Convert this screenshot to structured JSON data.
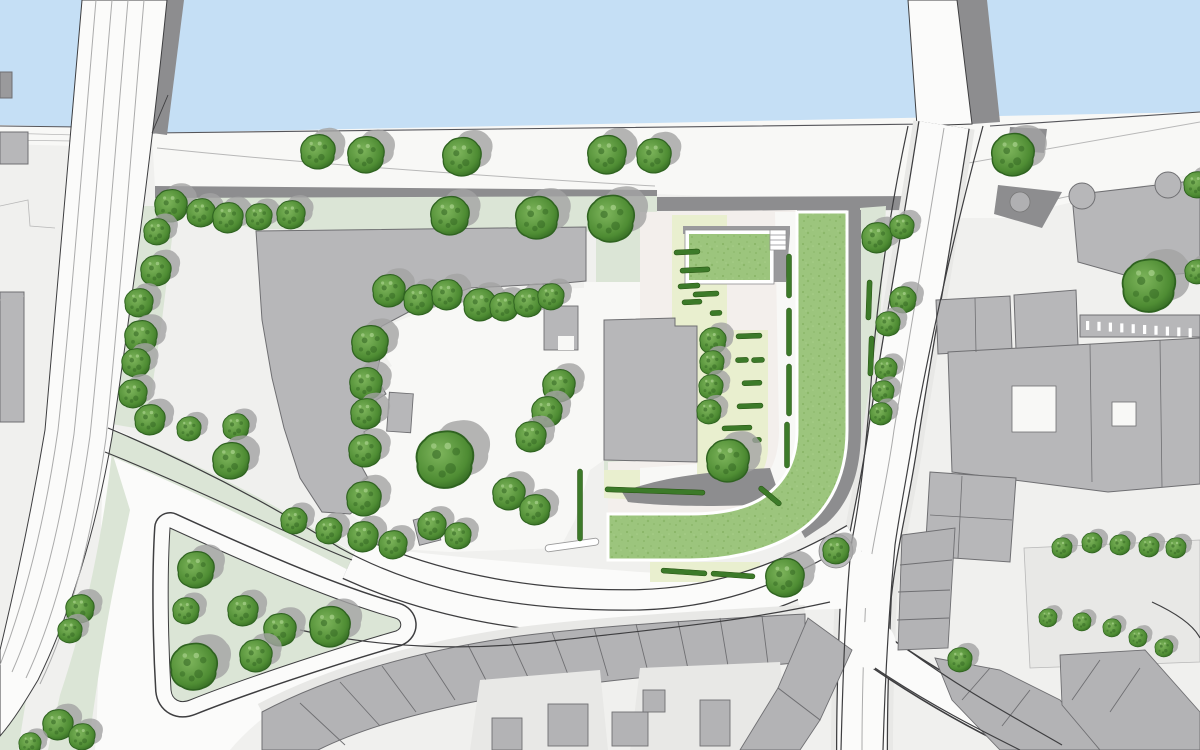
{
  "meta": {
    "title": "Riverside landscape masterplan site drawing",
    "type": "architectural-site-plan",
    "orientation": "plan view"
  },
  "palette": {
    "water": "#c5dff5",
    "land": "#f0f0ee",
    "road": "#fbfbfa",
    "sidewalk": "#e8e8e6",
    "plaza": "#f8f8f6",
    "dark_path": "#8d8d8f",
    "building": "#b7b7b9",
    "building_line": "#6f6f72",
    "terrace": "#b3b3b5",
    "sage": "#dbe5d6",
    "cream": "#e9efcf",
    "pink": "#f3efec",
    "lawn": "#9cc57d",
    "lawn_dark": "#85b263",
    "tree_mid": "#4e8c33",
    "tree_light": "#7eb55c",
    "tree_dark": "#2f6320",
    "tree_shadow": "#a3a3a3",
    "hedge": "#3c7a29",
    "hedge_dark": "#24500f",
    "line": "#3e3e40",
    "faint": "#b8b8b8",
    "lane": "#ababab"
  },
  "features": {
    "water_label": "river",
    "bridge_west": "road bridge with lane markings",
    "bridge_east": "road bridge",
    "promenade": "riverside promenade with tree row",
    "quay_path": "dark riverside walkway",
    "plaza": "central courtyard plaza",
    "lawn_building": "green-roof L-shaped building",
    "lawn_pavilion": "green-roof pavilion with stair",
    "park": "triangular pocket park",
    "terraces": "perimeter terrace housing",
    "court_grid": "courtyard with small tree grid"
  },
  "trees": {
    "promenade_row": [
      [
        318,
        152,
        17
      ],
      [
        366,
        155,
        18
      ],
      [
        462,
        157,
        19
      ],
      [
        607,
        155,
        19
      ],
      [
        654,
        156,
        17
      ],
      [
        1013,
        155,
        21
      ]
    ],
    "top_strip": [
      [
        171,
        206,
        16
      ],
      [
        201,
        213,
        14
      ],
      [
        228,
        218,
        15
      ],
      [
        259,
        217,
        13
      ],
      [
        291,
        215,
        14
      ],
      [
        450,
        216,
        19
      ],
      [
        537,
        218,
        21
      ],
      [
        611,
        219,
        23
      ]
    ],
    "west_column": [
      [
        157,
        232,
        13
      ],
      [
        156,
        271,
        15
      ],
      [
        139,
        303,
        14
      ],
      [
        141,
        337,
        16
      ],
      [
        136,
        363,
        14
      ],
      [
        133,
        394,
        14
      ],
      [
        150,
        420,
        15
      ]
    ],
    "plaza_north": [
      [
        389,
        291,
        16
      ],
      [
        419,
        300,
        15
      ],
      [
        447,
        295,
        15
      ],
      [
        480,
        305,
        16
      ],
      [
        504,
        307,
        14
      ],
      [
        528,
        303,
        14
      ],
      [
        551,
        297,
        13
      ]
    ],
    "plaza_west": [
      [
        370,
        344,
        18
      ],
      [
        366,
        384,
        16
      ],
      [
        366,
        414,
        15
      ],
      [
        365,
        451,
        16
      ],
      [
        364,
        499,
        17
      ],
      [
        363,
        537,
        15
      ],
      [
        393,
        545,
        14
      ]
    ],
    "plaza_east": [
      [
        559,
        386,
        16
      ],
      [
        547,
        412,
        15
      ],
      [
        531,
        437,
        15
      ],
      [
        509,
        494,
        16
      ],
      [
        535,
        510,
        15
      ],
      [
        432,
        526,
        14
      ],
      [
        458,
        536,
        13
      ]
    ],
    "central": [
      [
        445,
        460,
        28
      ]
    ],
    "site_courtyard": [
      [
        713,
        341,
        13
      ],
      [
        712,
        363,
        12
      ],
      [
        711,
        387,
        12
      ],
      [
        709,
        412,
        12
      ],
      [
        728,
        461,
        21
      ],
      [
        785,
        578,
        19
      ],
      [
        836,
        551,
        13
      ]
    ],
    "road_verge": [
      [
        189,
        429,
        12
      ],
      [
        236,
        427,
        13
      ],
      [
        231,
        461,
        18
      ],
      [
        294,
        521,
        13
      ],
      [
        329,
        531,
        13
      ]
    ],
    "park": [
      [
        196,
        570,
        18
      ],
      [
        186,
        611,
        13
      ],
      [
        243,
        611,
        15
      ],
      [
        280,
        630,
        16
      ],
      [
        330,
        627,
        20
      ],
      [
        194,
        667,
        23
      ],
      [
        256,
        656,
        16
      ]
    ],
    "southwest": [
      [
        80,
        609,
        14
      ],
      [
        70,
        631,
        12
      ],
      [
        58,
        725,
        15
      ],
      [
        82,
        737,
        13
      ],
      [
        30,
        744,
        11
      ]
    ],
    "east_road": [
      [
        877,
        238,
        15
      ],
      [
        902,
        227,
        12
      ],
      [
        903,
        300,
        13
      ],
      [
        888,
        324,
        12
      ],
      [
        886,
        369,
        11
      ],
      [
        883,
        392,
        11
      ],
      [
        881,
        414,
        11
      ]
    ],
    "northeast": [
      [
        1149,
        286,
        26
      ],
      [
        1197,
        272,
        12
      ],
      [
        1197,
        185,
        13
      ]
    ],
    "court_grid_small": [
      [
        1062,
        548,
        10
      ],
      [
        1092,
        543,
        10
      ],
      [
        1120,
        545,
        10
      ],
      [
        1149,
        547,
        10
      ],
      [
        1176,
        548,
        10
      ],
      [
        1048,
        618,
        9
      ],
      [
        1082,
        622,
        9
      ],
      [
        1112,
        628,
        9
      ],
      [
        1138,
        638,
        9
      ],
      [
        1164,
        648,
        9
      ],
      [
        960,
        660,
        12
      ]
    ]
  },
  "hedges": [
    [
      687,
      252,
      26,
      -3
    ],
    [
      695,
      270,
      30,
      -3
    ],
    [
      689,
      286,
      22,
      -3
    ],
    [
      706,
      294,
      26,
      -3
    ],
    [
      692,
      302,
      20,
      -3
    ],
    [
      716,
      313,
      12,
      -3
    ],
    [
      749,
      336,
      26,
      -2
    ],
    [
      742,
      360,
      13,
      -2
    ],
    [
      758,
      360,
      13,
      -2
    ],
    [
      752,
      383,
      20,
      -2
    ],
    [
      750,
      406,
      26,
      -2
    ],
    [
      737,
      428,
      30,
      -2
    ],
    [
      757,
      440,
      9,
      -2
    ],
    [
      655,
      491,
      100,
      2
    ],
    [
      684,
      572,
      46,
      4
    ],
    [
      733,
      575,
      44,
      4
    ],
    [
      789,
      276,
      44,
      90
    ],
    [
      789,
      332,
      48,
      90
    ],
    [
      789,
      390,
      52,
      90
    ],
    [
      787,
      445,
      46,
      90
    ],
    [
      580,
      505,
      72,
      90
    ],
    [
      770,
      496,
      28,
      40
    ],
    [
      869,
      300,
      40,
      92
    ],
    [
      871,
      356,
      40,
      92
    ]
  ],
  "structures": {
    "bench": {
      "x": 572,
      "y": 545,
      "len": 54,
      "rot": -8
    },
    "kiosk": {
      "x": 1020,
      "y": 202,
      "r": 10
    },
    "planter": {
      "x": 836,
      "y": 551,
      "r": 17
    },
    "stairs": {
      "x": 770,
      "y": 230,
      "w": 16,
      "h": 20,
      "steps": 4
    },
    "comb": {
      "x": 1086,
      "y": 321,
      "count": 10,
      "dx": 11.4,
      "dy": 0.8
    },
    "sheds": [
      [
        388,
        393,
        24,
        39,
        4
      ],
      [
        416,
        517,
        22,
        26,
        -14
      ],
      [
        544,
        306,
        34,
        44,
        0
      ]
    ]
  }
}
